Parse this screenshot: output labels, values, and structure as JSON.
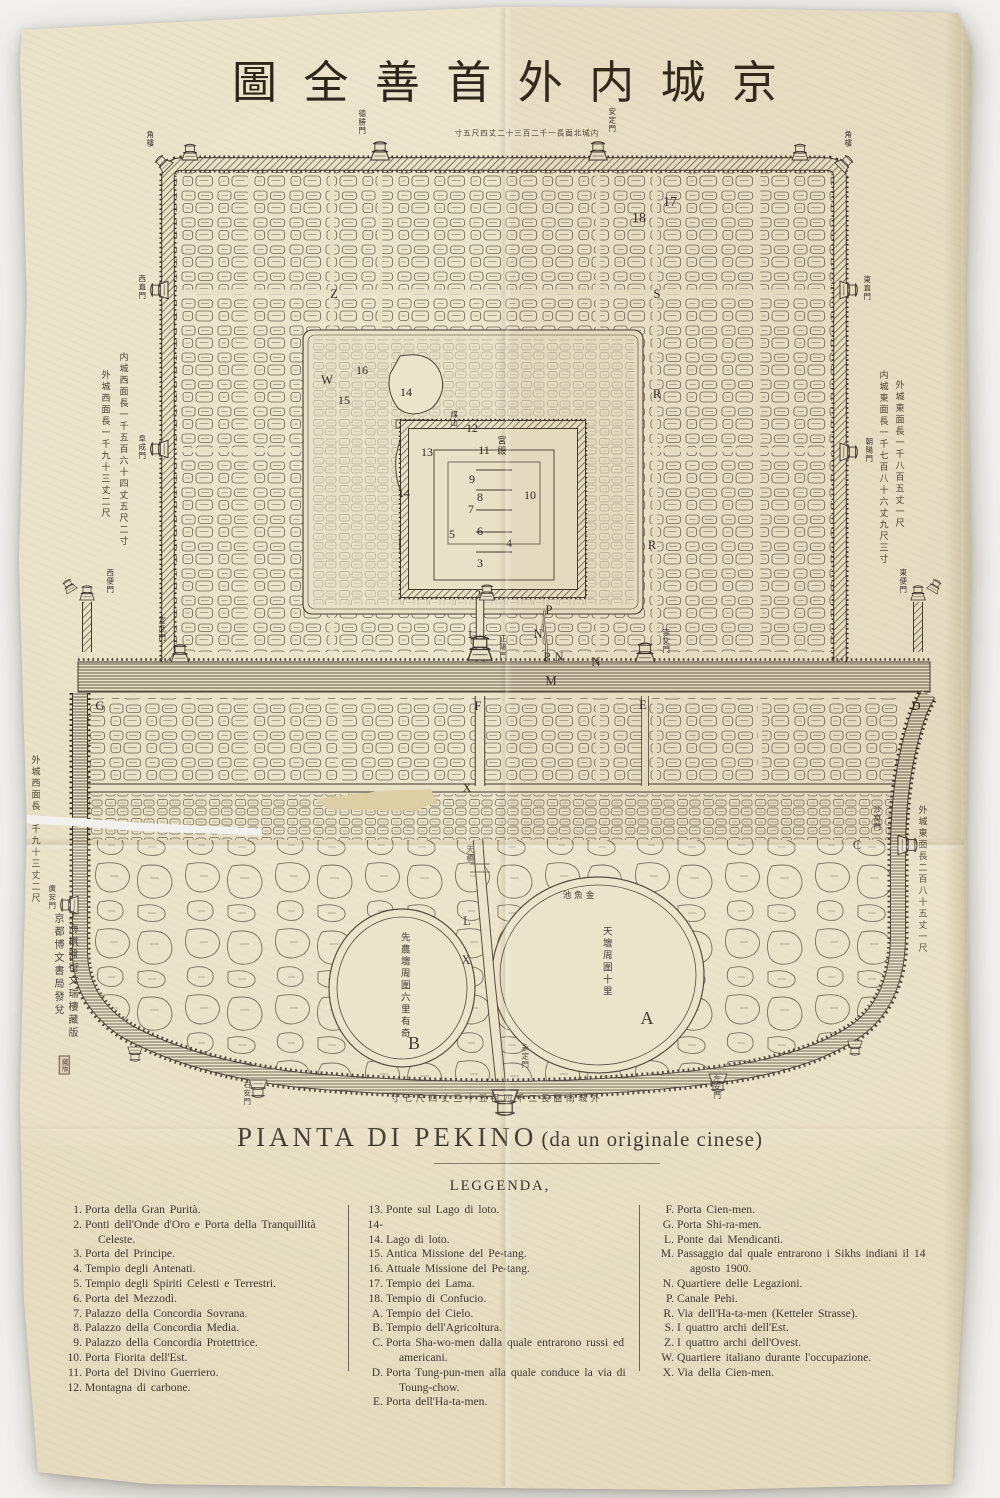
{
  "photo": {
    "backdrop": "#f1f0ed",
    "paper": "#e9e1c7",
    "ink": "#3b332a"
  },
  "title": {
    "reading": "京城内外首善全圖",
    "chars": [
      {
        "ch": "圖"
      },
      {
        "ch": "全"
      },
      {
        "ch": "善"
      },
      {
        "ch": "首"
      },
      {
        "ch": "外"
      },
      {
        "ch": "内"
      },
      {
        "ch": "城"
      },
      {
        "ch": "京"
      }
    ]
  },
  "caption": {
    "main": "PIANTA DI PEKINO",
    "paren": "(da un originale cinese)"
  },
  "legend": {
    "heading": "LEGGENDA,",
    "col1": [
      {
        "label": "1.",
        "text": "Porta della Gran Purità."
      },
      {
        "label": "2.",
        "text": "Ponti dell'Onde d'Oro e Porta della Tranquillità Celeste."
      },
      {
        "label": "3.",
        "text": "Porta del Principe."
      },
      {
        "label": "4.",
        "text": "Tempio degli Antenati."
      },
      {
        "label": "5.",
        "text": "Tempio degli Spiriti Celesti e Terrestri."
      },
      {
        "label": "6.",
        "text": "Porta del Mezzodì."
      },
      {
        "label": "7.",
        "text": "Palazzo della Concordia Sovrana."
      },
      {
        "label": "8.",
        "text": "Palazzo della Concordia Media."
      },
      {
        "label": "9.",
        "text": "Palazzo della Concordia Protettrice."
      },
      {
        "label": "10.",
        "text": "Porta Fiorita dell'Est."
      },
      {
        "label": "11.",
        "text": "Porta del Divino Guerriero."
      },
      {
        "label": "12.",
        "text": "Montagna di carbone."
      }
    ],
    "col2": [
      {
        "label": "13.",
        "text": "Ponte sul Lago di loto."
      },
      {
        "label": "14-14.",
        "text": "Lago di loto."
      },
      {
        "label": "15.",
        "text": "Antica Missione del Pe-tang."
      },
      {
        "label": "16.",
        "text": "Attuale Missione del Pe-tang."
      },
      {
        "label": "17.",
        "text": "Tempio dei Lama."
      },
      {
        "label": "18.",
        "text": "Tempio di Confucio."
      },
      {
        "label": "A.",
        "text": "Tempio del Cielo."
      },
      {
        "label": "B.",
        "text": "Tempio dell'Agricoltura."
      },
      {
        "label": "C.",
        "text": "Porta Sha-wo-men dalla quale entrarono russi ed americani."
      },
      {
        "label": "D.",
        "text": "Porta Tung-pun-men alla quale conduce la via di Toung-chow."
      },
      {
        "label": "E.",
        "text": "Porta dell'Ha-ta-men."
      }
    ],
    "col3": [
      {
        "label": "F.",
        "text": "Porta Cien-men."
      },
      {
        "label": "G.",
        "text": "Porta Shi-ra-men."
      },
      {
        "label": "L.",
        "text": "Ponte dai Mendicanti."
      },
      {
        "label": "M.",
        "text": "Passaggio dal quale entrarono i Sikhs indiani il 14 agosto 1900."
      },
      {
        "label": "N.",
        "text": "Quartiere delle Legazioni."
      },
      {
        "label": "P.",
        "text": "Canale Pehi."
      },
      {
        "label": "R.",
        "text": "Via dell'Ha-ta-men (Ketteler Strasse)."
      },
      {
        "label": "S.",
        "text": "I quattro archi dell'Est."
      },
      {
        "label": "Z.",
        "text": "I quattro archi dell'Ovest."
      },
      {
        "label": "W.",
        "text": "Quartiere italiano durante l'occupazione."
      },
      {
        "label": "X.",
        "text": "Via della Cien-men."
      }
    ]
  },
  "map": {
    "markers": [
      {
        "text": "1",
        "x": 470,
        "y": 634,
        "cls": "num"
      },
      {
        "text": "2",
        "x": 478,
        "y": 594,
        "cls": "num"
      },
      {
        "text": "3",
        "x": 480,
        "y": 563,
        "cls": "num"
      },
      {
        "text": "4",
        "x": 509,
        "y": 543,
        "cls": "num"
      },
      {
        "text": "5",
        "x": 452,
        "y": 534,
        "cls": "num"
      },
      {
        "text": "6",
        "x": 480,
        "y": 531,
        "cls": "num"
      },
      {
        "text": "7",
        "x": 471,
        "y": 509,
        "cls": "num"
      },
      {
        "text": "8",
        "x": 480,
        "y": 497,
        "cls": "num"
      },
      {
        "text": "9",
        "x": 472,
        "y": 479,
        "cls": "num"
      },
      {
        "text": "10",
        "x": 530,
        "y": 495,
        "cls": "num"
      },
      {
        "text": "11",
        "x": 484,
        "y": 450,
        "cls": "num"
      },
      {
        "text": "12",
        "x": 472,
        "y": 428,
        "cls": "num"
      },
      {
        "text": "13",
        "x": 427,
        "y": 452,
        "cls": "num"
      },
      {
        "text": "14",
        "x": 406,
        "y": 392,
        "cls": "num"
      },
      {
        "text": "14",
        "x": 404,
        "y": 493,
        "cls": "num"
      },
      {
        "text": "15",
        "x": 344,
        "y": 400,
        "cls": "num"
      },
      {
        "text": "16",
        "x": 362,
        "y": 370,
        "cls": "num"
      },
      {
        "text": "17",
        "x": 670,
        "y": 203,
        "cls": "num md"
      },
      {
        "text": "18",
        "x": 639,
        "y": 219,
        "cls": "num md"
      },
      {
        "text": "W",
        "x": 327,
        "y": 380,
        "cls": "ltr"
      },
      {
        "text": "R",
        "x": 657,
        "y": 394,
        "cls": "ltr"
      },
      {
        "text": "R",
        "x": 652,
        "y": 545,
        "cls": "ltr"
      },
      {
        "text": "S",
        "x": 657,
        "y": 294,
        "cls": "ltr"
      },
      {
        "text": "Z",
        "x": 334,
        "y": 294,
        "cls": "ltr"
      },
      {
        "text": "M",
        "x": 551,
        "y": 681,
        "cls": "ltr md"
      },
      {
        "text": "F",
        "x": 478,
        "y": 706,
        "cls": "ltr"
      },
      {
        "text": "E",
        "x": 643,
        "y": 705,
        "cls": "ltr"
      },
      {
        "text": "P",
        "x": 549,
        "y": 610,
        "cls": "ltr"
      },
      {
        "text": "N",
        "x": 538,
        "y": 634,
        "cls": "ltr"
      },
      {
        "text": "P",
        "x": 547,
        "y": 657,
        "cls": "ltr"
      },
      {
        "text": "N",
        "x": 559,
        "y": 657,
        "cls": "ltr"
      },
      {
        "text": "N",
        "x": 596,
        "y": 662,
        "cls": "ltr"
      },
      {
        "text": "C",
        "x": 857,
        "y": 845,
        "cls": "ltr"
      },
      {
        "text": "D",
        "x": 916,
        "y": 706,
        "cls": "ltr"
      },
      {
        "text": "G",
        "x": 100,
        "y": 706,
        "cls": "ltr"
      },
      {
        "text": "L",
        "x": 467,
        "y": 921,
        "cls": "ltr"
      },
      {
        "text": "X",
        "x": 466,
        "y": 960,
        "cls": "ltr"
      },
      {
        "text": "X",
        "x": 467,
        "y": 788,
        "cls": "ltr"
      },
      {
        "text": "A",
        "x": 647,
        "y": 1018,
        "cls": "big"
      },
      {
        "text": "B",
        "x": 414,
        "y": 1043,
        "cls": "big"
      },
      {
        "text": "德勝門",
        "x": 362,
        "y": 122,
        "cls": "gate"
      },
      {
        "text": "安定門",
        "x": 612,
        "y": 120,
        "cls": "gate"
      },
      {
        "text": "角樓",
        "x": 150,
        "y": 139,
        "cls": "gate"
      },
      {
        "text": "角樓",
        "x": 848,
        "y": 139,
        "cls": "gate"
      },
      {
        "text": "西直門",
        "x": 142,
        "y": 287,
        "cls": "gate"
      },
      {
        "text": "阜成門",
        "x": 142,
        "y": 447,
        "cls": "gate"
      },
      {
        "text": "東直門",
        "x": 867,
        "y": 288,
        "cls": "gate"
      },
      {
        "text": "朝陽門",
        "x": 869,
        "y": 450,
        "cls": "gate"
      },
      {
        "text": "宣武門",
        "x": 162,
        "y": 629,
        "cls": "gate"
      },
      {
        "text": "正陽門",
        "x": 503,
        "y": 647,
        "cls": "gate"
      },
      {
        "text": "崇文門",
        "x": 666,
        "y": 641,
        "cls": "gate"
      },
      {
        "text": "西便門",
        "x": 110,
        "y": 581,
        "cls": "gate"
      },
      {
        "text": "東便門",
        "x": 903,
        "y": 581,
        "cls": "gate"
      },
      {
        "text": "廣安門",
        "x": 52,
        "y": 897,
        "cls": "gate"
      },
      {
        "text": "沙窩門",
        "x": 877,
        "y": 818,
        "cls": "gate"
      },
      {
        "text": "右安門",
        "x": 247,
        "y": 1093,
        "cls": "gate"
      },
      {
        "text": "左安門",
        "x": 717,
        "y": 1087,
        "cls": "gate"
      },
      {
        "text": "永定門",
        "x": 525,
        "y": 1056,
        "cls": "gate"
      },
      {
        "text": "天橋",
        "x": 470,
        "y": 854,
        "cls": "gate"
      },
      {
        "text": "煤山",
        "x": 454,
        "y": 419,
        "cls": "gate"
      },
      {
        "text": "宮殿",
        "x": 500,
        "y": 446,
        "cls": "cjk"
      },
      {
        "text": "池魚金",
        "x": 580,
        "y": 896,
        "cls": "cjkh"
      },
      {
        "text": "天壇周圍十里",
        "x": 606,
        "y": 962,
        "cls": "tall"
      },
      {
        "text": "先農壇周圍六里有奇",
        "x": 404,
        "y": 986,
        "cls": "tall"
      },
      {
        "text": "内城西面長一千五百六十四丈五尺二寸",
        "x": 122,
        "y": 450,
        "cls": "ann"
      },
      {
        "text": "外城西面長一千九十三丈二尺",
        "x": 104,
        "y": 445,
        "cls": "ann"
      },
      {
        "text": "外城東面長一千八百五丈一尺",
        "x": 898,
        "y": 455,
        "cls": "ann"
      },
      {
        "text": "内城東面長一千七百八十六丈九尺三寸",
        "x": 882,
        "y": 468,
        "cls": "ann"
      },
      {
        "text": "外城東面長二百八十五丈一尺",
        "x": 921,
        "y": 880,
        "cls": "ann"
      },
      {
        "text": "外城西面長一千九十三丈二尺",
        "x": 34,
        "y": 830,
        "cls": "ann"
      },
      {
        "text": "寸五尺四丈二十三百二千一長面北城内",
        "x": 527,
        "y": 133,
        "cls": "annh"
      },
      {
        "text": "寸七尺四丈三十五百四千二長面南城外",
        "x": 497,
        "y": 1100,
        "cls": "annh2"
      },
      {
        "text": "京都博文書局發兌",
        "x": 57,
        "y": 965,
        "cls": "pub"
      },
      {
        "text": "上海棋盤街文瑞樓藏版",
        "x": 71,
        "y": 975,
        "cls": "pub"
      },
      {
        "text": "藏版",
        "x": 64,
        "y": 1065,
        "cls": "seal"
      }
    ]
  }
}
